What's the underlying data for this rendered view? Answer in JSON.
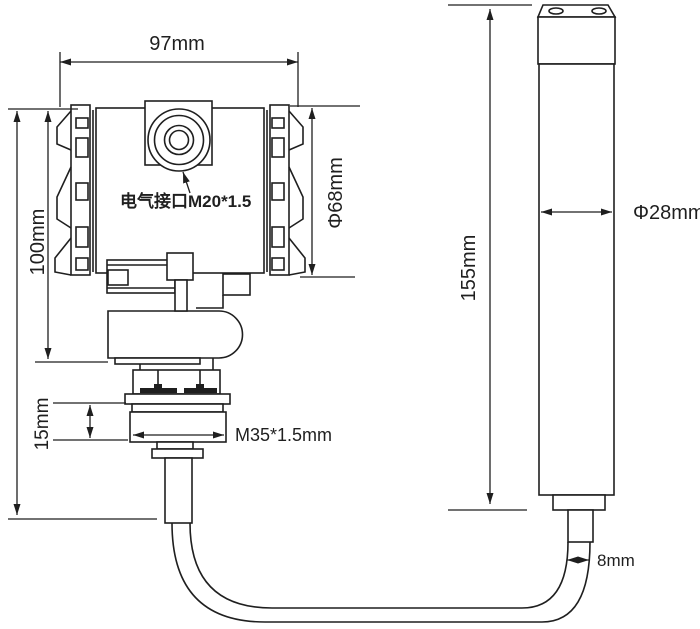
{
  "page": {
    "background_color": "#ffffff",
    "line_color": "#1f1f1f"
  },
  "drawing": {
    "labels": {
      "head_width": "97mm",
      "head_height": "100mm",
      "head_diameter": "Φ68mm",
      "electrical_port": "电气接口M20*1.5",
      "thread_height": "15mm",
      "process_thread": "M35*1.5mm",
      "probe_length": "155mm",
      "probe_diameter": "Φ28mm",
      "cable_diameter": "8mm"
    }
  }
}
